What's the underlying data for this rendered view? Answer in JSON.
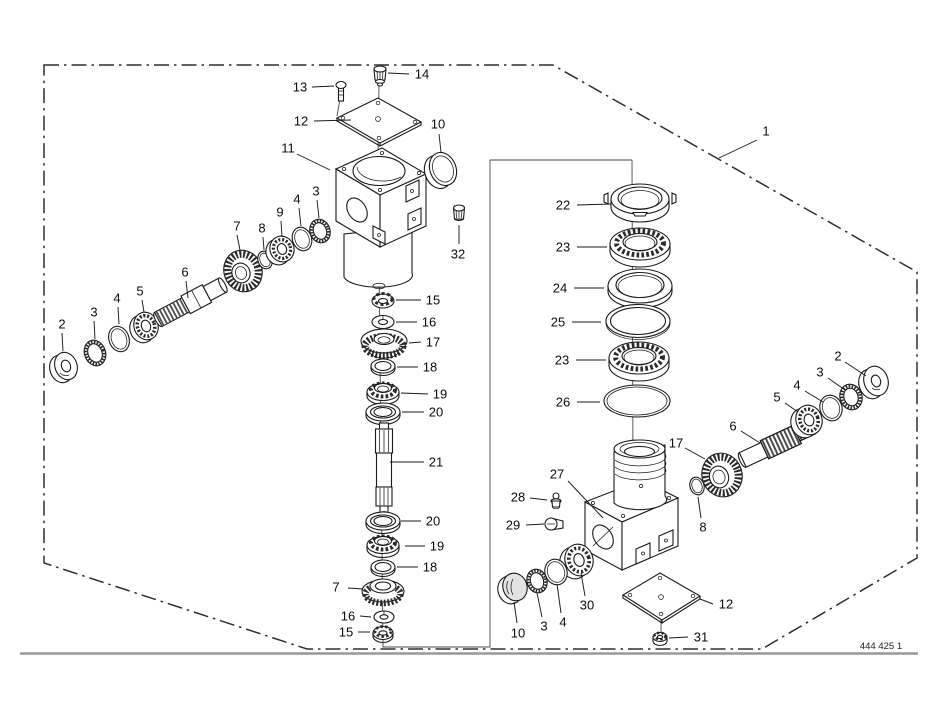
{
  "diagram": {
    "drawing_number": "444 425 1",
    "callouts": [
      {
        "part": "1",
        "tx": 766,
        "ty": 131,
        "x1": 757,
        "y1": 140,
        "x2": 719,
        "y2": 158
      },
      {
        "part": "13",
        "tx": 300,
        "ty": 87,
        "x1": 312,
        "y1": 87,
        "x2": 334,
        "y2": 86
      },
      {
        "part": "14",
        "tx": 422,
        "ty": 74,
        "x1": 409,
        "y1": 74,
        "x2": 388,
        "y2": 73
      },
      {
        "part": "12",
        "tx": 301,
        "ty": 121,
        "x1": 314,
        "y1": 121,
        "x2": 351,
        "y2": 120
      },
      {
        "part": "11",
        "tx": 288,
        "ty": 148,
        "x1": 297,
        "y1": 154,
        "x2": 330,
        "y2": 170
      },
      {
        "part": "10",
        "tx": 438,
        "ty": 124,
        "x1": 439,
        "y1": 134,
        "x2": 441,
        "y2": 152
      },
      {
        "part": "32",
        "tx": 458,
        "ty": 254,
        "x1": 459,
        "y1": 244,
        "x2": 459,
        "y2": 225
      },
      {
        "part": "2",
        "tx": 62,
        "ty": 324,
        "x1": 62,
        "y1": 333,
        "x2": 63,
        "y2": 351
      },
      {
        "part": "3",
        "tx": 94,
        "ty": 312,
        "x1": 94,
        "y1": 321,
        "x2": 95,
        "y2": 339
      },
      {
        "part": "4",
        "tx": 117,
        "ty": 298,
        "x1": 118,
        "y1": 307,
        "x2": 119,
        "y2": 324
      },
      {
        "part": "5",
        "tx": 140,
        "ty": 291,
        "x1": 142,
        "y1": 300,
        "x2": 144,
        "y2": 312
      },
      {
        "part": "6",
        "tx": 185,
        "ty": 272,
        "x1": 186,
        "y1": 281,
        "x2": 188,
        "y2": 298
      },
      {
        "part": "7",
        "tx": 237,
        "ty": 226,
        "x1": 237,
        "y1": 235,
        "x2": 240,
        "y2": 250
      },
      {
        "part": "8",
        "tx": 262,
        "ty": 228,
        "x1": 263,
        "y1": 237,
        "x2": 264,
        "y2": 250
      },
      {
        "part": "9",
        "tx": 280,
        "ty": 212,
        "x1": 281,
        "y1": 221,
        "x2": 282,
        "y2": 237
      },
      {
        "part": "4",
        "tx": 297,
        "ty": 199,
        "x1": 299,
        "y1": 208,
        "x2": 301,
        "y2": 226
      },
      {
        "part": "3",
        "tx": 316,
        "ty": 191,
        "x1": 317,
        "y1": 200,
        "x2": 319,
        "y2": 218
      },
      {
        "part": "15",
        "tx": 433,
        "ty": 300,
        "x1": 421,
        "y1": 300,
        "x2": 396,
        "y2": 300
      },
      {
        "part": "16",
        "tx": 429,
        "ty": 322,
        "x1": 417,
        "y1": 322,
        "x2": 396,
        "y2": 322
      },
      {
        "part": "17",
        "tx": 433,
        "ty": 342,
        "x1": 421,
        "y1": 342,
        "x2": 409,
        "y2": 343
      },
      {
        "part": "18",
        "tx": 430,
        "ty": 367,
        "x1": 418,
        "y1": 367,
        "x2": 397,
        "y2": 367
      },
      {
        "part": "19",
        "tx": 440,
        "ty": 394,
        "x1": 428,
        "y1": 394,
        "x2": 401,
        "y2": 393
      },
      {
        "part": "20",
        "tx": 436,
        "ty": 412,
        "x1": 424,
        "y1": 412,
        "x2": 402,
        "y2": 412
      },
      {
        "part": "21",
        "tx": 436,
        "ty": 462,
        "x1": 424,
        "y1": 462,
        "x2": 390,
        "y2": 462
      },
      {
        "part": "20",
        "tx": 433,
        "ty": 521,
        "x1": 421,
        "y1": 521,
        "x2": 401,
        "y2": 521
      },
      {
        "part": "19",
        "tx": 437,
        "ty": 546,
        "x1": 425,
        "y1": 546,
        "x2": 405,
        "y2": 546
      },
      {
        "part": "18",
        "tx": 430,
        "ty": 567,
        "x1": 418,
        "y1": 567,
        "x2": 397,
        "y2": 567
      },
      {
        "part": "7",
        "tx": 336,
        "ty": 587,
        "x1": 348,
        "y1": 588,
        "x2": 363,
        "y2": 589
      },
      {
        "part": "16",
        "tx": 348,
        "ty": 616,
        "x1": 360,
        "y1": 616,
        "x2": 371,
        "y2": 617
      },
      {
        "part": "15",
        "tx": 346,
        "ty": 632,
        "x1": 358,
        "y1": 632,
        "x2": 370,
        "y2": 632
      },
      {
        "part": "22",
        "tx": 563,
        "ty": 205,
        "x1": 577,
        "y1": 205,
        "x2": 611,
        "y2": 204
      },
      {
        "part": "23",
        "tx": 563,
        "ty": 247,
        "x1": 577,
        "y1": 247,
        "x2": 607,
        "y2": 247
      },
      {
        "part": "24",
        "tx": 560,
        "ty": 288,
        "x1": 574,
        "y1": 288,
        "x2": 604,
        "y2": 288
      },
      {
        "part": "25",
        "tx": 558,
        "ty": 322,
        "x1": 572,
        "y1": 322,
        "x2": 601,
        "y2": 322
      },
      {
        "part": "23",
        "tx": 562,
        "ty": 360,
        "x1": 576,
        "y1": 360,
        "x2": 606,
        "y2": 360
      },
      {
        "part": "26",
        "tx": 563,
        "ty": 402,
        "x1": 577,
        "y1": 402,
        "x2": 600,
        "y2": 402
      },
      {
        "part": "2",
        "tx": 838,
        "ty": 356,
        "x1": 845,
        "y1": 362,
        "x2": 866,
        "y2": 376
      },
      {
        "part": "3",
        "tx": 820,
        "ty": 372,
        "x1": 828,
        "y1": 378,
        "x2": 845,
        "y2": 390
      },
      {
        "part": "4",
        "tx": 797,
        "ty": 385,
        "x1": 805,
        "y1": 391,
        "x2": 823,
        "y2": 402
      },
      {
        "part": "5",
        "tx": 777,
        "ty": 397,
        "x1": 785,
        "y1": 403,
        "x2": 798,
        "y2": 412
      },
      {
        "part": "6",
        "tx": 733,
        "ty": 426,
        "x1": 741,
        "y1": 431,
        "x2": 760,
        "y2": 443
      },
      {
        "part": "17",
        "tx": 676,
        "ty": 443,
        "x1": 685,
        "y1": 448,
        "x2": 705,
        "y2": 459
      },
      {
        "part": "8",
        "tx": 703,
        "ty": 527,
        "x1": 701,
        "y1": 518,
        "x2": 698,
        "y2": 497
      },
      {
        "part": "27",
        "tx": 557,
        "ty": 474,
        "x1": 568,
        "y1": 481,
        "x2": 603,
        "y2": 518
      },
      {
        "part": "28",
        "tx": 518,
        "ty": 497,
        "x1": 530,
        "y1": 498,
        "x2": 547,
        "y2": 500
      },
      {
        "part": "29",
        "tx": 513,
        "ty": 525,
        "x1": 526,
        "y1": 525,
        "x2": 544,
        "y2": 524
      },
      {
        "part": "30",
        "tx": 587,
        "ty": 605,
        "x1": 585,
        "y1": 596,
        "x2": 581,
        "y2": 573
      },
      {
        "part": "4",
        "tx": 563,
        "ty": 622,
        "x1": 561,
        "y1": 613,
        "x2": 557,
        "y2": 584
      },
      {
        "part": "3",
        "tx": 544,
        "ty": 626,
        "x1": 542,
        "y1": 617,
        "x2": 537,
        "y2": 593
      },
      {
        "part": "10",
        "tx": 518,
        "ty": 633,
        "x1": 517,
        "y1": 623,
        "x2": 514,
        "y2": 602
      },
      {
        "part": "12",
        "tx": 726,
        "ty": 604,
        "x1": 713,
        "y1": 604,
        "x2": 700,
        "y2": 599
      },
      {
        "part": "31",
        "tx": 701,
        "ty": 637,
        "x1": 688,
        "y1": 637,
        "x2": 669,
        "y2": 638
      }
    ]
  }
}
